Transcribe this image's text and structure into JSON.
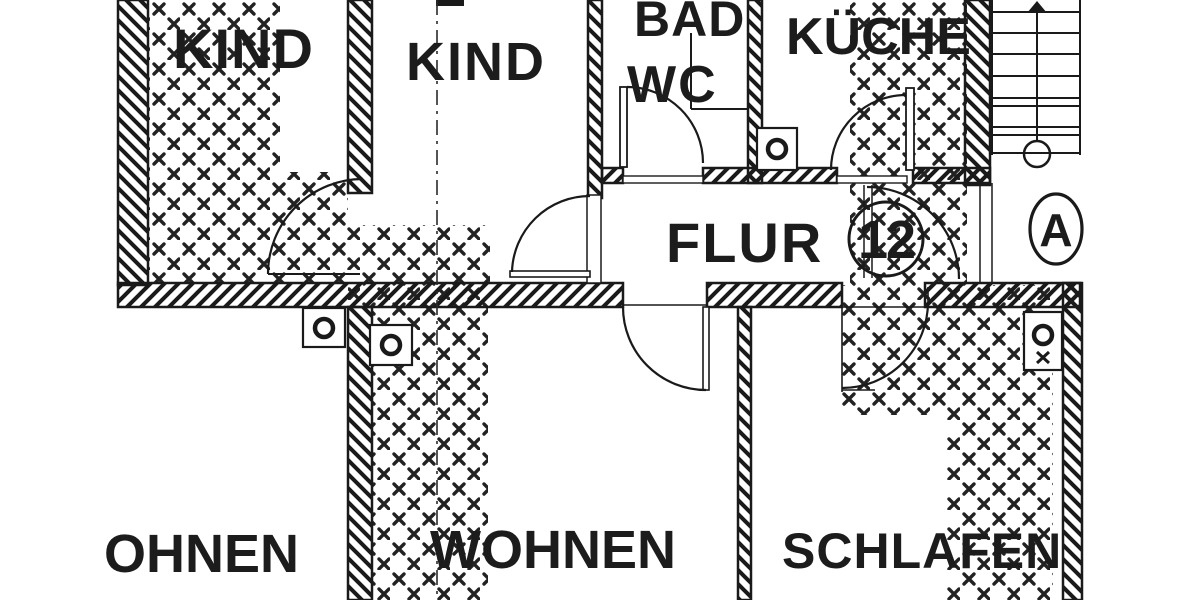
{
  "plan": {
    "type": "apartment-floor-plan-scan",
    "language": "de",
    "rooms": {
      "kind_left": "KIND",
      "kind_mid": "KIND",
      "bad_line1": "BAD",
      "bad_line2": "WC",
      "kueche": "KÜCHE",
      "flur": "FLUR",
      "wohnen_left_partial": "OHNEN",
      "wohnen": "WOHNEN",
      "schlafen": "SCHLAFEN"
    },
    "markers": {
      "apartment_number": "12",
      "stairwell_letter": "A"
    },
    "colors": {
      "ink": "#1c1c1c",
      "paper": "#ffffff"
    }
  }
}
